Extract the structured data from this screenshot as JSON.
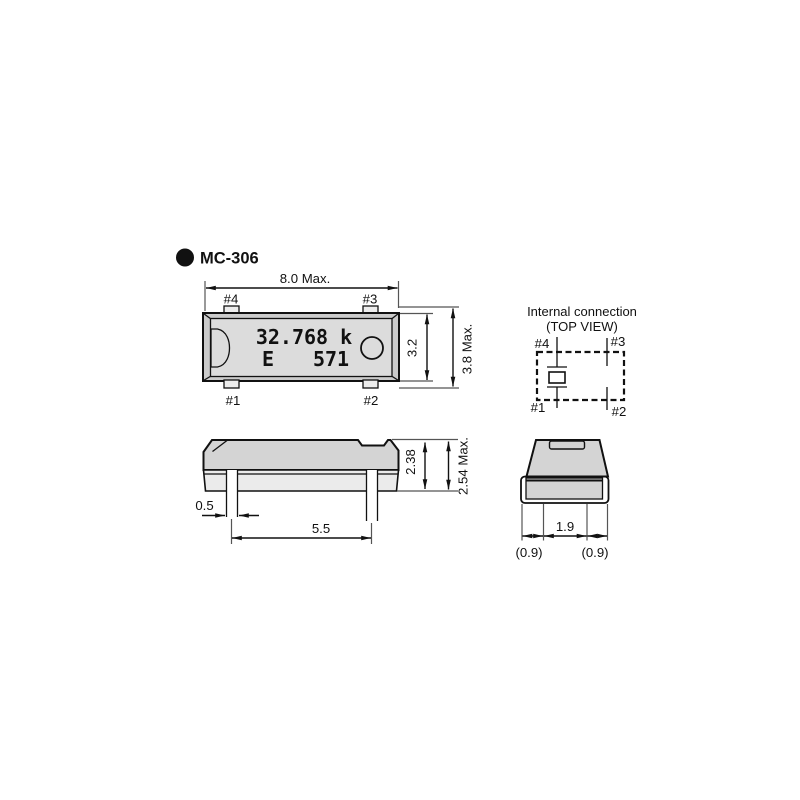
{
  "header": {
    "model": "MC-306"
  },
  "top_view": {
    "dim_width": "8.0 Max.",
    "pin4": "#4",
    "pin3": "#3",
    "pin1": "#1",
    "pin2": "#2",
    "marking_freq": "32.768 k",
    "marking_grade": "E",
    "marking_code": "571",
    "dim_body_height": "3.2",
    "dim_overall_height": "3.8 Max."
  },
  "internal_connection": {
    "title": "Internal connection",
    "subtitle": "(TOP VIEW)",
    "pin4": "#4",
    "pin3": "#3",
    "pin1": "#1",
    "pin2": "#2"
  },
  "side_view": {
    "dim_lead_width": "0.5",
    "dim_lead_pitch": "5.5",
    "dim_body_height": "2.38",
    "dim_overall_height": "2.54 Max."
  },
  "end_view": {
    "dim_lead_span": "1.9",
    "dim_left_margin": "(0.9)",
    "dim_right_margin": "(0.9)"
  },
  "colors": {
    "background": "#ffffff",
    "outline": "#111111",
    "body_frame_fill": "#cbcbcb",
    "body_face_fill": "#dcdcdc",
    "side_face_fill": "#d4d4d4",
    "side_lower_fill": "#ebebeb",
    "extension_line": "#555555",
    "text": "#111111"
  }
}
